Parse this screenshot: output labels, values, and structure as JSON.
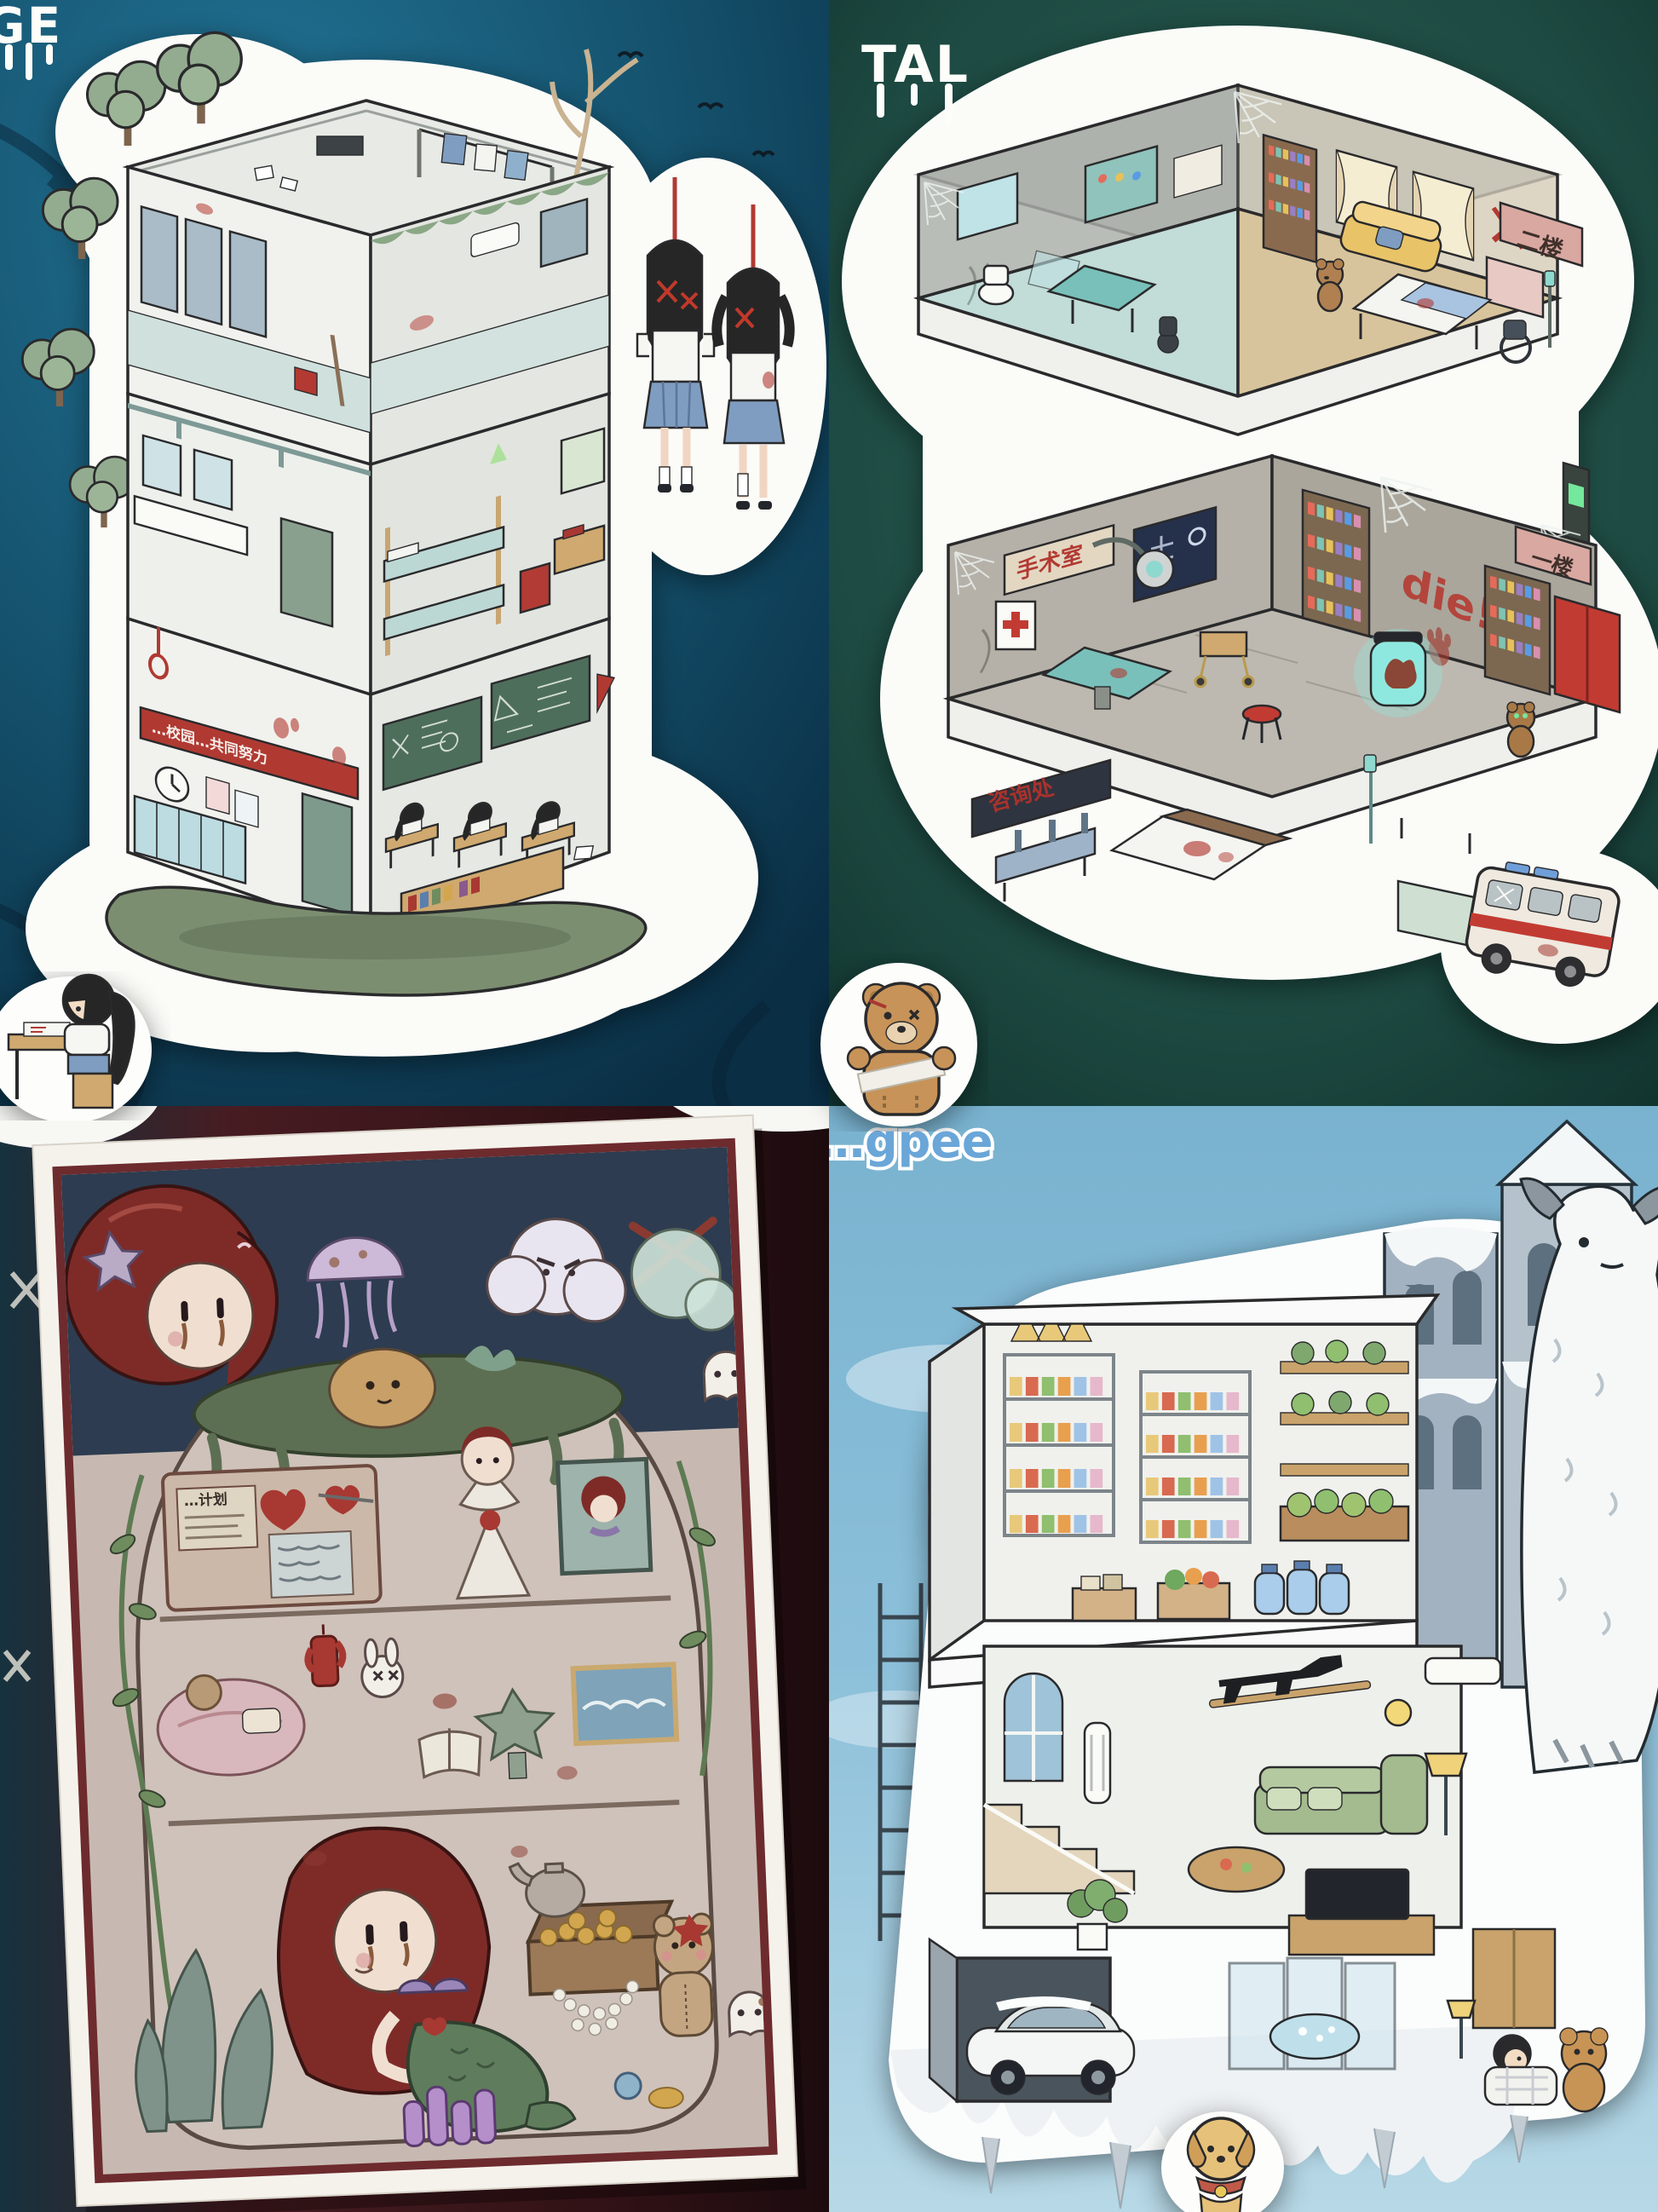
{
  "page": {
    "background": "#0b2534"
  },
  "panels": {
    "school": {
      "title_fragment": "GE",
      "banner_text": "…校园…共同努力",
      "background": "#17597a"
    },
    "hospital": {
      "title_fragment": "TAL",
      "sign_floor_2": "二楼",
      "sign_floor_1": "一楼",
      "sign_operating_room": "手术室",
      "sign_information_desk": "咨询处",
      "wall_graffiti": "die!",
      "background": "#1f4f46"
    },
    "mermaid": {
      "board_note_text": "…计划",
      "background": "#3c181c"
    },
    "bunker": {
      "watermark_fragment": "…gpee",
      "background": "#8cc0da"
    }
  },
  "colors": {
    "sticker_white": "#fbfbf8",
    "plaque_pink": "#d9a8a0",
    "sign_red_text": "#b23a32",
    "graffiti_red": "#b5382f",
    "banner_red": "#b03a32",
    "exit_glow_green": "#74e89c",
    "specimen_jar_glow": "#8fe8df",
    "blackboard_green": "#4e6e5c",
    "locker_cyan": "#bcdce2",
    "skirt_blue": "#7f9dc0",
    "sofa_yellow": "#e9c368",
    "sofa_green": "#a3bb8e",
    "mermaid_hair_red": "#7e2b28",
    "tail_green": "#5f7d5c",
    "sky_blue": "#8cc0da",
    "castle_gray": "#a3b2c0",
    "ambulance_stripe_red": "#c23b32"
  }
}
